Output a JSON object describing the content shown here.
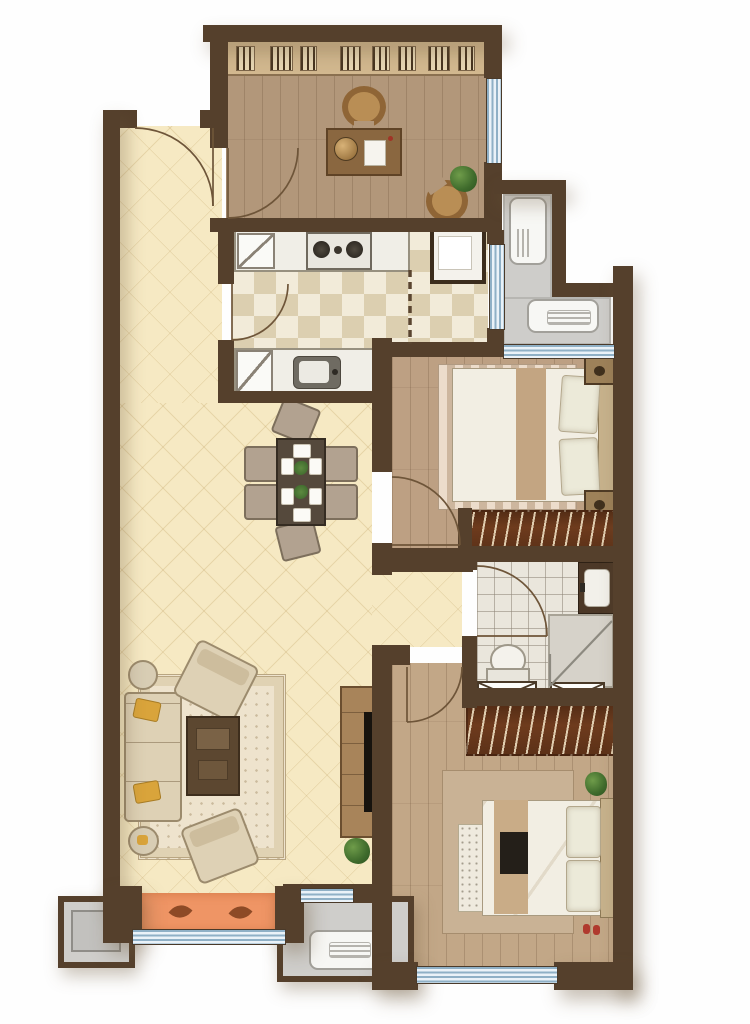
{
  "meta": {
    "label": "Apartment floor plan, top-down furnished view",
    "canvas_width": 750,
    "canvas_height": 1024
  },
  "palette": {
    "wall": "#55402c",
    "wood_floor": "#b2977a",
    "wood_floor_light": "#c2a787",
    "cream_floor": "#f6e9c3",
    "checker_light": "#f2ebd9",
    "checker_dark": "#dccfb0",
    "bath_tile": "#eae6dc",
    "balcony_gray": "#cecdca",
    "window_blue": "#8fb0c6",
    "orange_mat": "#ef9565",
    "wardrobe_wood": "#6e3b1d",
    "tv_black": "#17130e",
    "plant_green": "#4a7434"
  },
  "rooms": {
    "study": {
      "label": "Study with desk, chair and bookshelf wall"
    },
    "kitchen": {
      "label": "Kitchen with checkered tile, stove, sink and fridge"
    },
    "dining_living": {
      "label": "Open-plan dining and living area with cream diamond floor"
    },
    "utility_balcony": {
      "label": "L-shaped utility balcony with washing machine"
    },
    "bedroom1": {
      "label": "Bedroom with double bed, nightstands and closet"
    },
    "bathroom": {
      "label": "Bathroom with shower, vanity sink and toilet"
    },
    "master_bedroom": {
      "label": "Master bedroom with double bed, bench and wardrobe"
    },
    "bay_window": {
      "label": "Bay window ledge with orange mat and leaf prints"
    },
    "ac_platform_left": {
      "label": "Outdoor AC platform (left)"
    },
    "ac_platform_right": {
      "label": "Outdoor AC platform with unit (right)"
    },
    "entry": {
      "label": "Entry door with swing arc"
    }
  },
  "furniture": {
    "study": [
      "bookshelf",
      "desk",
      "desk-globe",
      "desk-paper",
      "desk-chair",
      "guest-chair",
      "plant"
    ],
    "kitchen": [
      "upper-counter",
      "cooktop-two-burners",
      "prep-box",
      "refrigerator",
      "lower-counter",
      "sink",
      "sliding-door-dashed"
    ],
    "dining": [
      "dining-table",
      "six-chairs",
      "four-placemats",
      "two-centerpieces"
    ],
    "living": [
      "three-seat-sofa",
      "two-accent-chairs",
      "two-side-tables",
      "ornate-rug",
      "coffee-table",
      "tv-console",
      "tv",
      "plant"
    ],
    "bedroom1": [
      "double-bed",
      "two-pillows",
      "striped-rug",
      "two-nightstands",
      "wall-tv",
      "hanger-closet"
    ],
    "bathroom": [
      "vanity-sink",
      "corner-shower",
      "toilet",
      "two-duct-shafts"
    ],
    "master_bedroom": [
      "hanger-wardrobe",
      "double-bed",
      "two-pillows",
      "bed-runner",
      "foot-bench",
      "area-rug",
      "plant",
      "slippers"
    ],
    "balcony": [
      "washing-machine",
      "storage-unit"
    ]
  }
}
